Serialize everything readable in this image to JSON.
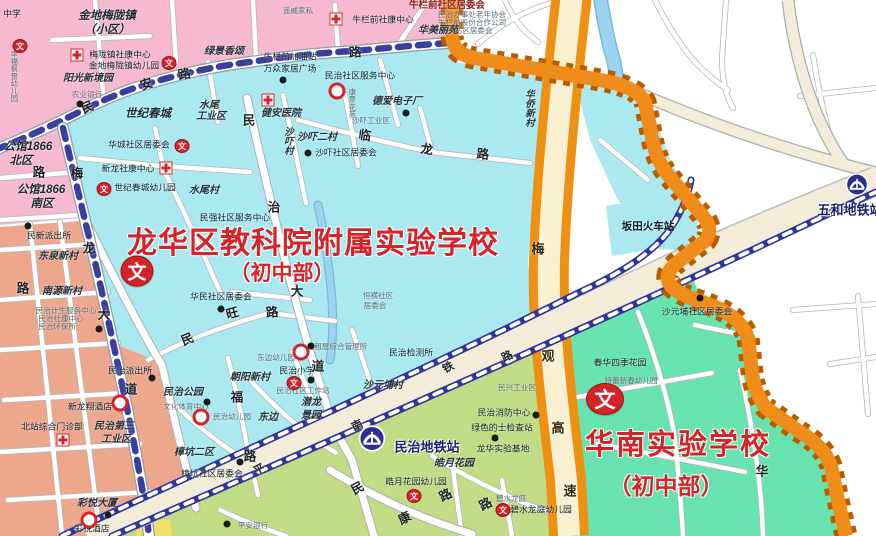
{
  "map": {
    "colors": {
      "pink": "#f6b9cf",
      "salmon": "#eda78d",
      "cyan": "#abe9f1",
      "cyan_light": "#bfeef6",
      "spring_green": "#68e2ae",
      "yellow_green": "#c0dc85",
      "yellow_patch": "#f2df6a",
      "river": "#9ed3f0",
      "road_cream": "#f3ecd7",
      "rail_blue": "#30349b",
      "boundary_orange": "#ef8c1a",
      "boundary_dash": "#b85c00",
      "highway_orange": "#ee9012",
      "title_red": "#d5232a"
    },
    "badge_glyph": "文",
    "big_titles": [
      {
        "t": "龙华区教科院附属实验学校",
        "x": 313,
        "y": 240,
        "fs": 30,
        "ls": 1
      },
      {
        "t": "（初中部）",
        "x": 282,
        "y": 272,
        "fs": 21,
        "ls": 0
      },
      {
        "t": "华南实验学校",
        "x": 678,
        "y": 442,
        "fs": 29,
        "ls": 2
      },
      {
        "t": "（初中部）",
        "x": 666,
        "y": 484,
        "fs": 23,
        "ls": 0
      }
    ],
    "badges": [
      {
        "x": 137,
        "y": 271,
        "w": 31,
        "h": 29,
        "fs": 19
      },
      {
        "x": 605,
        "y": 399,
        "w": 36,
        "h": 30,
        "fs": 21
      }
    ],
    "stations": [
      {
        "name": "民治地铁站",
        "icon_x": 372,
        "icon_y": 441,
        "size": 27,
        "lx": 427,
        "ly": 446
      },
      {
        "name": "五和地铁站",
        "icon_x": 857,
        "icon_y": 187,
        "size": 23,
        "lx": 850,
        "ly": 209
      }
    ],
    "labels": [
      {
        "t": "中学",
        "x": 12,
        "y": 14,
        "cls": "o"
      },
      {
        "t": "幸福枫景幼儿园",
        "x": 14,
        "y": 76,
        "cls": "sv"
      },
      {
        "t": "金地梅陇镇",
        "x": 107,
        "y": 16,
        "cls": "pl"
      },
      {
        "t": "（小区）",
        "x": 107,
        "y": 30,
        "cls": "pl"
      },
      {
        "t": "梅陇镇社康中心",
        "x": 120,
        "y": 55,
        "cls": "o"
      },
      {
        "t": "金地梅陇镇幼儿园",
        "x": 124,
        "y": 66,
        "cls": "o"
      },
      {
        "t": "阳光新境园",
        "x": 88,
        "y": 79,
        "cls": "p"
      },
      {
        "t": "农业银行",
        "x": 87,
        "y": 95,
        "cls": "s"
      },
      {
        "t": "遥威家私",
        "x": 298,
        "y": 11,
        "cls": "s"
      },
      {
        "t": "牛栏前社区居委会",
        "x": 447,
        "y": 6,
        "cls": "rp"
      },
      {
        "t": "民治办事处老年协会",
        "x": 472,
        "y": 15,
        "cls": "s"
      },
      {
        "t": "牛栏前股份合作公司",
        "x": 472,
        "y": 23,
        "cls": "s"
      },
      {
        "t": "新牛坊区居委会",
        "x": 466,
        "y": 31,
        "cls": "s"
      },
      {
        "t": "牛栏前社康中心",
        "x": 383,
        "y": 20,
        "cls": "o"
      },
      {
        "t": "华美丽苑",
        "x": 438,
        "y": 31,
        "cls": "p"
      },
      {
        "t": "绿景香颂",
        "x": 224,
        "y": 52,
        "cls": "p"
      },
      {
        "t": "牛栏前加油站",
        "x": 290,
        "y": 57,
        "cls": "o"
      },
      {
        "t": "万众家居广场",
        "x": 290,
        "y": 69,
        "cls": "o"
      },
      {
        "t": "民治社区服务中心",
        "x": 360,
        "y": 76,
        "cls": "o"
      },
      {
        "t": "康景花苑",
        "x": 352,
        "y": 103,
        "cls": "sv"
      },
      {
        "t": "水尾",
        "x": 209,
        "y": 106,
        "cls": "p"
      },
      {
        "t": "工业区",
        "x": 211,
        "y": 117,
        "cls": "p"
      },
      {
        "t": "世纪春城",
        "x": 148,
        "y": 114,
        "cls": "pl"
      },
      {
        "t": "水尾村",
        "x": 204,
        "y": 191,
        "cls": "p"
      },
      {
        "t": "健安医院",
        "x": 281,
        "y": 114,
        "cls": "p"
      },
      {
        "t": "沙吓村",
        "x": 287,
        "y": 141,
        "cls": "v"
      },
      {
        "t": "沙吓二村",
        "x": 317,
        "y": 138,
        "cls": "p"
      },
      {
        "t": "沙吓社区居委会",
        "x": 346,
        "y": 153,
        "cls": "o"
      },
      {
        "t": "华城社区居委会",
        "x": 139,
        "y": 145,
        "cls": "o"
      },
      {
        "t": "新龙社康中心",
        "x": 128,
        "y": 169,
        "cls": "o"
      },
      {
        "t": "世纪春城幼儿园",
        "x": 145,
        "y": 188,
        "cls": "o"
      },
      {
        "t": "民强社区服务中心",
        "x": 235,
        "y": 218,
        "cls": "o"
      },
      {
        "t": "德爱电子厂",
        "x": 397,
        "y": 102,
        "cls": "p"
      },
      {
        "t": "沙吓工业区",
        "x": 371,
        "y": 121,
        "cls": "s"
      },
      {
        "t": "华侨新村",
        "x": 528,
        "y": 108,
        "cls": "v"
      },
      {
        "t": "华民社区居委会",
        "x": 221,
        "y": 297,
        "cls": "o"
      },
      {
        "t": "恒横社区",
        "x": 378,
        "y": 296,
        "cls": "s"
      },
      {
        "t": "居委会",
        "x": 375,
        "y": 306,
        "cls": "s"
      },
      {
        "t": "民治检测所",
        "x": 411,
        "y": 353,
        "cls": "o"
      },
      {
        "t": "沙元埔村",
        "x": 383,
        "y": 386,
        "cls": "p"
      },
      {
        "t": "潜龙",
        "x": 311,
        "y": 403,
        "cls": "p"
      },
      {
        "t": "景园",
        "x": 311,
        "y": 416,
        "cls": "p"
      },
      {
        "t": "东边",
        "x": 268,
        "y": 418,
        "cls": "p"
      },
      {
        "t": "民治公园",
        "x": 183,
        "y": 393,
        "cls": "p"
      },
      {
        "t": "文化体育中心",
        "x": 186,
        "y": 407,
        "cls": "s"
      },
      {
        "t": "民治幼儿园",
        "x": 232,
        "y": 417,
        "cls": "s"
      },
      {
        "t": "朝阳新村",
        "x": 250,
        "y": 378,
        "cls": "p"
      },
      {
        "t": "民治小学",
        "x": 297,
        "y": 371,
        "cls": "o"
      },
      {
        "t": "民治社区工作站",
        "x": 303,
        "y": 391,
        "cls": "s"
      },
      {
        "t": "东边幼儿园",
        "x": 276,
        "y": 358,
        "cls": "s"
      },
      {
        "t": "出租屋综合管理所",
        "x": 337,
        "y": 347,
        "cls": "s"
      },
      {
        "t": "樟坑二区",
        "x": 194,
        "y": 453,
        "cls": "p"
      },
      {
        "t": "樟坑社区居委会",
        "x": 212,
        "y": 474,
        "cls": "o"
      },
      {
        "t": "民治派出所",
        "x": 130,
        "y": 371,
        "cls": "o"
      },
      {
        "t": "坂田火车站",
        "x": 648,
        "y": 227,
        "cls": "ob"
      },
      {
        "t": "公馆1866",
        "x": 28,
        "y": 147,
        "cls": "pl"
      },
      {
        "t": "北区",
        "x": 21,
        "y": 161,
        "cls": "pl"
      },
      {
        "t": "公馆1866",
        "x": 41,
        "y": 190,
        "cls": "pl"
      },
      {
        "t": "南区",
        "x": 42,
        "y": 204,
        "cls": "pl"
      },
      {
        "t": "民新派出所",
        "x": 49,
        "y": 236,
        "cls": "o"
      },
      {
        "t": "东泉新村",
        "x": 58,
        "y": 257,
        "cls": "p"
      },
      {
        "t": "南源新村",
        "x": 62,
        "y": 292,
        "cls": "p"
      },
      {
        "t": "民治计生服务中心",
        "x": 66,
        "y": 311,
        "cls": "s"
      },
      {
        "t": "民治社康中心",
        "x": 61,
        "y": 319,
        "cls": "s"
      },
      {
        "t": "民治环保所",
        "x": 57,
        "y": 327,
        "cls": "s"
      },
      {
        "t": "民治第三",
        "x": 114,
        "y": 427,
        "cls": "p"
      },
      {
        "t": "工业区",
        "x": 116,
        "y": 440,
        "cls": "p"
      },
      {
        "t": "北站综合门诊部",
        "x": 52,
        "y": 427,
        "cls": "o"
      },
      {
        "t": "新龙翔酒店",
        "x": 90,
        "y": 407,
        "cls": "o"
      },
      {
        "t": "彩悦大厦",
        "x": 97,
        "y": 504,
        "cls": "p"
      },
      {
        "t": "彩悦酒店",
        "x": 92,
        "y": 529,
        "cls": "o"
      },
      {
        "t": "皓月花园",
        "x": 454,
        "y": 464,
        "cls": "p"
      },
      {
        "t": "皓月花园幼儿园",
        "x": 416,
        "y": 482,
        "cls": "o"
      },
      {
        "t": "碧水龙庭",
        "x": 511,
        "y": 499,
        "cls": "s"
      },
      {
        "t": "碧水龙庭幼儿园",
        "x": 541,
        "y": 510,
        "cls": "o"
      },
      {
        "t": "平安银行",
        "x": 253,
        "y": 526,
        "cls": "s"
      },
      {
        "t": "民兴工业区",
        "x": 517,
        "y": 388,
        "cls": "s"
      },
      {
        "t": "民治消防中心",
        "x": 504,
        "y": 413,
        "cls": "o"
      },
      {
        "t": "绿色的士检查站",
        "x": 502,
        "y": 428,
        "cls": "o"
      },
      {
        "t": "龙华实验基地",
        "x": 503,
        "y": 449,
        "cls": "o"
      },
      {
        "t": "春华四季花园",
        "x": 620,
        "y": 363,
        "cls": "o"
      },
      {
        "t": "特蕾新春幼儿园",
        "x": 631,
        "y": 381,
        "cls": "s"
      },
      {
        "t": "沙元埔社区居委会",
        "x": 697,
        "y": 312,
        "cls": "o"
      }
    ],
    "road_chars": [
      {
        "t": "民",
        "x": 87,
        "y": 106,
        "r": -24
      },
      {
        "t": "安",
        "x": 146,
        "y": 83,
        "r": -18
      },
      {
        "t": "路",
        "x": 184,
        "y": 73,
        "r": -12
      },
      {
        "t": "路",
        "x": 355,
        "y": 51,
        "r": -5
      },
      {
        "t": "梅",
        "x": 77,
        "y": 172,
        "r": 0
      },
      {
        "t": "龙",
        "x": 89,
        "y": 247,
        "r": 0
      },
      {
        "t": "大",
        "x": 104,
        "y": 313,
        "r": 0
      },
      {
        "t": "道",
        "x": 131,
        "y": 388,
        "r": 0
      },
      {
        "t": "民",
        "x": 249,
        "y": 119,
        "r": 0
      },
      {
        "t": "治",
        "x": 274,
        "y": 206,
        "r": 0
      },
      {
        "t": "大",
        "x": 297,
        "y": 290,
        "r": 0
      },
      {
        "t": "道",
        "x": 318,
        "y": 365,
        "r": 0
      },
      {
        "t": "临",
        "x": 365,
        "y": 134,
        "r": 8
      },
      {
        "t": "龙",
        "x": 427,
        "y": 148,
        "r": 8
      },
      {
        "t": "路",
        "x": 483,
        "y": 153,
        "r": 5
      },
      {
        "t": "民",
        "x": 187,
        "y": 338,
        "r": -22
      },
      {
        "t": "旺",
        "x": 232,
        "y": 312,
        "r": -15
      },
      {
        "t": "路",
        "x": 272,
        "y": 311,
        "r": -5
      },
      {
        "t": "福",
        "x": 237,
        "y": 396,
        "r": 0
      },
      {
        "t": "路",
        "x": 250,
        "y": 455,
        "r": 0
      },
      {
        "t": "民",
        "x": 357,
        "y": 487,
        "r": -28
      },
      {
        "t": "康",
        "x": 404,
        "y": 517,
        "r": -28
      },
      {
        "t": "路",
        "x": 445,
        "y": 494,
        "r": -28
      },
      {
        "t": "路",
        "x": 485,
        "y": 503,
        "r": -28
      },
      {
        "t": "路",
        "x": 39,
        "y": 171,
        "r": 0
      },
      {
        "t": "路",
        "x": 23,
        "y": 287,
        "r": 0
      },
      {
        "t": "华",
        "x": 762,
        "y": 470,
        "r": 0
      },
      {
        "t": "平",
        "x": 259,
        "y": 469,
        "r": -28,
        "cls": "railchar"
      },
      {
        "t": "南",
        "x": 357,
        "y": 425,
        "r": -28,
        "cls": "railchar"
      },
      {
        "t": "铁",
        "x": 448,
        "y": 367,
        "r": -28,
        "cls": "railchar"
      },
      {
        "t": "路",
        "x": 507,
        "y": 356,
        "r": -26,
        "cls": "railchar"
      },
      {
        "t": "梅",
        "x": 538,
        "y": 248,
        "r": 0,
        "cls": "hwchar"
      },
      {
        "t": "观",
        "x": 548,
        "y": 355,
        "r": 0,
        "cls": "hwchar"
      },
      {
        "t": "高",
        "x": 558,
        "y": 427,
        "r": 0,
        "cls": "hwchar"
      },
      {
        "t": "速",
        "x": 570,
        "y": 490,
        "r": 0,
        "cls": "hwchar"
      }
    ],
    "icons": {
      "dots": [
        [
          80,
          104
        ],
        [
          283,
          80
        ],
        [
          406,
          113
        ],
        [
          308,
          153
        ],
        [
          221,
          309
        ],
        [
          28,
          226
        ],
        [
          99,
          329
        ],
        [
          152,
          378
        ],
        [
          207,
          402
        ],
        [
          240,
          462
        ],
        [
          311,
          380
        ],
        [
          311,
          346
        ],
        [
          536,
          415
        ],
        [
          495,
          438
        ],
        [
          227,
          524
        ],
        [
          108,
          515
        ],
        [
          700,
          298
        ]
      ],
      "crosses": [
        [
          77,
          55
        ],
        [
          336,
          19
        ],
        [
          268,
          100
        ],
        [
          166,
          168
        ],
        [
          63,
          440
        ]
      ],
      "wens": [
        [
          20,
          46
        ],
        [
          169,
          63
        ],
        [
          182,
          146
        ],
        [
          104,
          189
        ],
        [
          294,
          383
        ],
        [
          414,
          496
        ],
        [
          503,
          510
        ]
      ],
      "rings": [
        [
          337,
          91
        ],
        [
          120,
          403
        ],
        [
          89,
          520
        ],
        [
          201,
          417
        ],
        [
          301,
          352
        ]
      ]
    }
  }
}
